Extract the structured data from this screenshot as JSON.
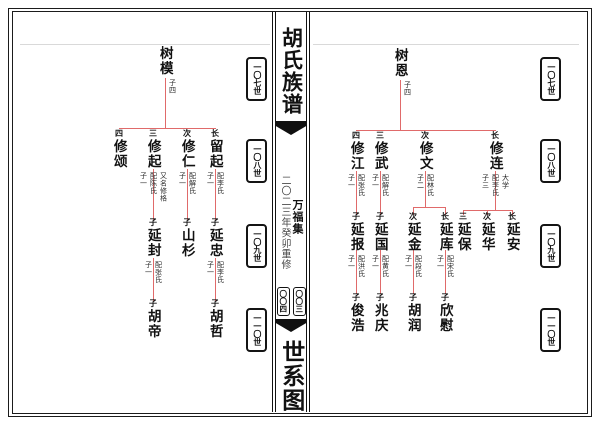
{
  "spine": {
    "title": "胡氏族谱",
    "volume_label": "万福集",
    "edition_note": "二〇二三年癸卯重修",
    "page_numbers": [
      "〇〇四",
      "〇〇三"
    ],
    "section_title": "世系图"
  },
  "generation_badges": [
    "一〇七世",
    "一〇八世",
    "一〇九世",
    "一一〇世"
  ],
  "colors": {
    "tree_line": "#e06a6a",
    "ink": "#111111",
    "muted_note": "#4a4a4a"
  },
  "left_page": {
    "root": {
      "name": "树模",
      "anns": [
        "子四"
      ]
    },
    "gen2": [
      {
        "rank": "长",
        "name": "留起",
        "anns": [
          "子一",
          "配李氏"
        ]
      },
      {
        "rank": "次",
        "name": "修仁",
        "anns": [
          "子一",
          "配解氏"
        ]
      },
      {
        "rank": "三",
        "name": "修起",
        "anns": [
          "子一",
          "配陈氏",
          "又名修格"
        ]
      },
      {
        "rank": "四",
        "name": "修颂",
        "anns": []
      }
    ],
    "gen3": [
      {
        "rank": "子",
        "name": "延忠",
        "anns": [
          "子一",
          "配李氏"
        ]
      },
      {
        "rank": "子",
        "name": "山杉",
        "anns": []
      },
      {
        "rank": "子",
        "name": "延封",
        "anns": [
          "子一",
          "配张氏"
        ]
      }
    ],
    "gen4": [
      {
        "rank": "子",
        "name": "胡哲"
      },
      {
        "rank": "子",
        "name": "胡帝"
      }
    ]
  },
  "right_page": {
    "root": {
      "name": "树恩",
      "anns": [
        "子四"
      ]
    },
    "gen2": [
      {
        "rank": "长",
        "name": "修连",
        "anns": [
          "子三",
          "配李氏",
          "大学"
        ]
      },
      {
        "rank": "次",
        "name": "修文",
        "anns": [
          "子二",
          "配林氏"
        ]
      },
      {
        "rank": "三",
        "name": "修武",
        "anns": [
          "子一",
          "配解氏"
        ]
      },
      {
        "rank": "四",
        "name": "修江",
        "anns": [
          "子一",
          "配张氏"
        ]
      }
    ],
    "gen3": [
      {
        "rank": "长",
        "name": "延安",
        "anns": []
      },
      {
        "rank": "次",
        "name": "延华",
        "anns": []
      },
      {
        "rank": "三",
        "name": "延保",
        "anns": []
      },
      {
        "rank": "长",
        "name": "延库",
        "anns": [
          "子一",
          "配宋氏"
        ]
      },
      {
        "rank": "次",
        "name": "延金",
        "anns": [
          "子一",
          "配段氏"
        ]
      },
      {
        "rank": "子",
        "name": "延国",
        "anns": [
          "子一",
          "配黄氏"
        ]
      },
      {
        "rank": "子",
        "name": "延报",
        "anns": [
          "子一",
          "配洪氏"
        ]
      }
    ],
    "gen4": [
      {
        "rank": "子",
        "name": "欣慰"
      },
      {
        "rank": "子",
        "name": "胡润"
      },
      {
        "rank": "子",
        "name": "兆庆"
      },
      {
        "rank": "子",
        "name": "俊浩"
      }
    ]
  }
}
